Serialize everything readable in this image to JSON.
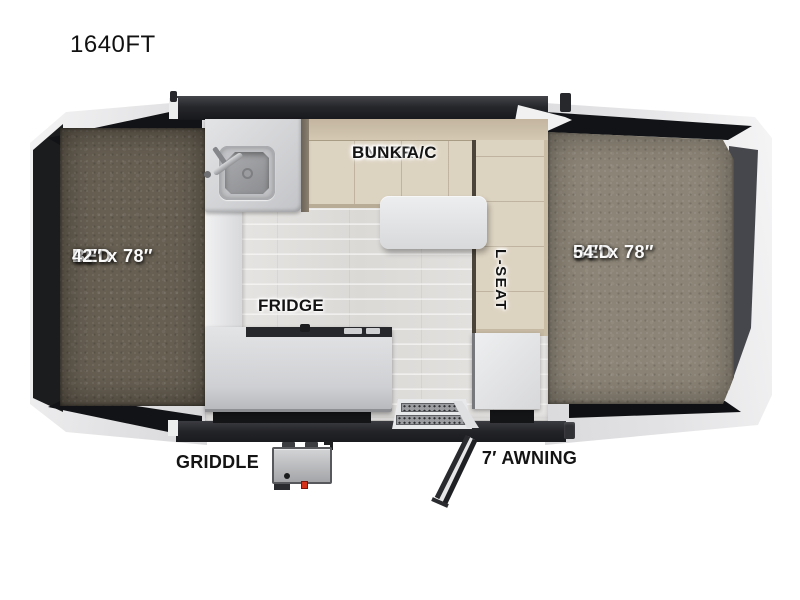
{
  "title": "1640FT",
  "floorplan": {
    "bed_left": {
      "line1": "BED",
      "line2": "42″ x 78″"
    },
    "bed_right": {
      "line1": "BED",
      "line2": "54″ x 78″"
    },
    "under_bunk": {
      "line1": "UNDER",
      "line2": "BUNK A/C"
    },
    "l_seat": "L-SEAT",
    "fridge": "FRIDGE",
    "griddle": "GRIDDLE",
    "awning": "7′ AWNING",
    "icons": [
      "sink-icon",
      "faucet-icon",
      "dinette-table-icon",
      "entry-step-icon",
      "awning-arm-icon",
      "griddle-icon"
    ],
    "colors": {
      "wall_dark": "#26272b",
      "tent_frame_white": "#ebebec",
      "mattress_left": "#675f52",
      "mattress_right": "#8c8476",
      "bench_tan": "#ddd3c1",
      "bench_backrest": "#c9bca7",
      "counter_gray": "#cfd0d3",
      "floor_light": "#e3e1df",
      "griddle_switch_red": "#d5321c"
    }
  }
}
